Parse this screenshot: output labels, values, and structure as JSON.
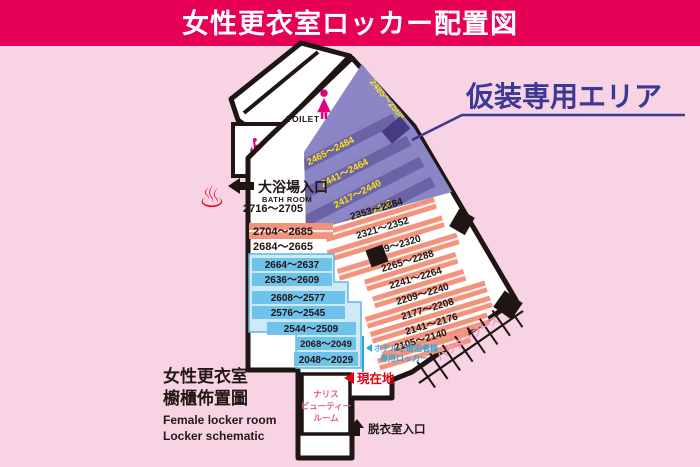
{
  "header": {
    "title": "女性更衣室ロッカー配置図"
  },
  "area_title": {
    "label": "仮装専用エリア"
  },
  "legend": {
    "jp1": "女性更衣室",
    "jp2": "櫥櫃佈置圖",
    "en1": "Female locker room",
    "en2": "Locker schematic"
  },
  "landmarks": {
    "toilet": "TOILET",
    "bath_jp": "大浴場入口",
    "bath_en": "BATH ROOM",
    "powder": "パウダーブース",
    "hotel1": "ホテルご宿泊者様",
    "hotel2": "専用ロッカー",
    "current": "現在地",
    "beauty1": "ナリス",
    "beauty2": "ビューティー",
    "beauty3": "ルーム",
    "undress": "脱衣室入口"
  },
  "icons": {
    "wheelchair": "♿",
    "hot_spring": "♨"
  },
  "lockers": {
    "costume_edge": "2485～2508",
    "costume": [
      "2465～2484",
      "2441～2464",
      "2417～2440",
      "2385～2416"
    ],
    "main": [
      "2353～2384",
      "2321～2352",
      "2289～2320",
      "2265～2288",
      "2241～2264",
      "2209～2240",
      "2177～2208",
      "2141～2176",
      "2105～2140"
    ],
    "left_top": "2716～2705",
    "left_bar": "2704～2685",
    "left_below": "2684～2665",
    "hotel_blue": [
      "2664～2637",
      "2636～2609",
      "2608～2577",
      "2576～2545",
      "2544～2509",
      "2068～2049",
      "2048～2029"
    ]
  },
  "colors": {
    "header_bg": "#e60056",
    "page_bg": "#f7d3e4",
    "wall": "#1f1613",
    "costume_zone": "#8b87c6",
    "costume_bar": "#6c63a6",
    "costume_label": "#f6e11c",
    "salmon_bar": "#f2937d",
    "hotel_zone": "#cfe9f7",
    "hotel_bar": "#6fc2e9",
    "accent_navy": "#3c3896",
    "accent_red": "#e60012",
    "accent_pink": "#e6007e",
    "accent_cyan": "#2ca6e0"
  }
}
